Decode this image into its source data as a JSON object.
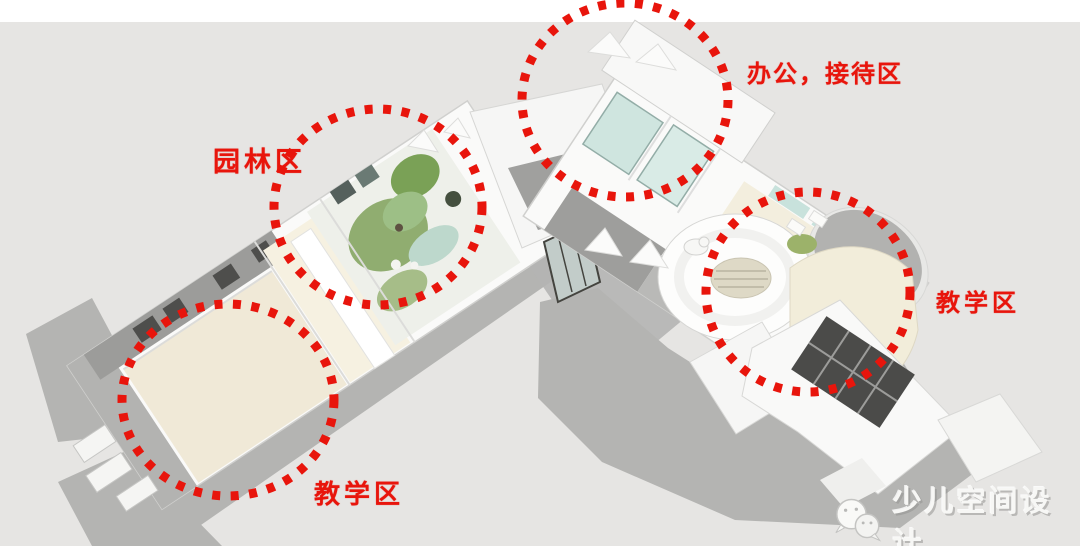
{
  "colors": {
    "accent_red": "#e8150c",
    "background_gray": "#e6e5e3",
    "top_bar_white": "#ffffff",
    "building_white": "#fafaf9",
    "roof_gray": "#9c9c9a",
    "shadow_gray": "#b4b4b2",
    "floor_beige": "#f0e9d7",
    "garden_green": "#8fae6e",
    "glass_teal": "#cfe5df",
    "watermark_white": "#f7f7f5"
  },
  "zones": [
    {
      "id": "garden",
      "label": "园林区"
    },
    {
      "id": "office_reception",
      "label": "办公，接待区"
    },
    {
      "id": "teaching_right",
      "label": "教学区"
    },
    {
      "id": "teaching_left",
      "label": "教学区"
    }
  ],
  "watermark": {
    "icon": "wechat-logo-icon",
    "text": "少儿空间设计"
  }
}
